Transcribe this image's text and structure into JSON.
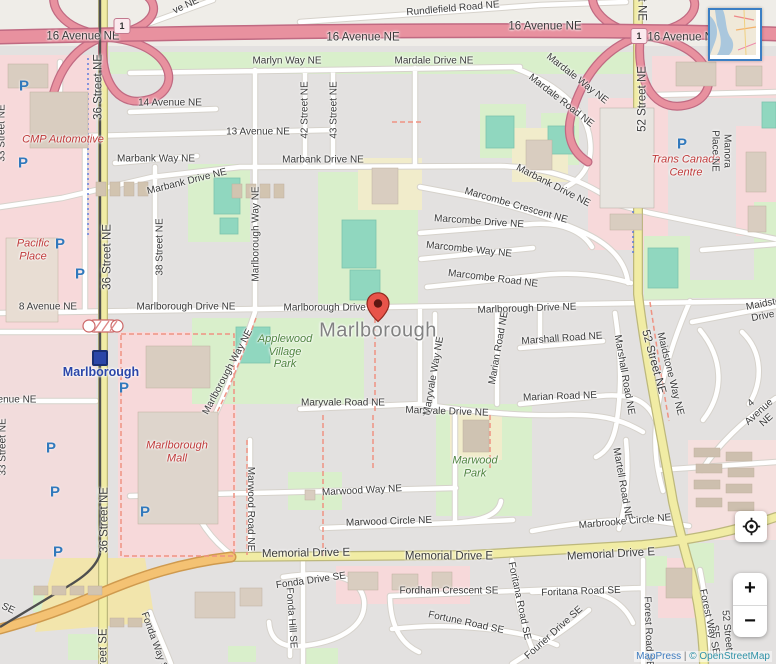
{
  "title": "Marlborough neighbourhood map",
  "marker": {
    "name": "Marlborough",
    "color": "#e8544a"
  },
  "city_label": "Marlborough",
  "station": {
    "name": "Marlborough",
    "icon": "ctrain-station-icon",
    "color": "#2b46a8"
  },
  "highway_shields": [
    {
      "label": "1",
      "x": 122,
      "y": 26
    },
    {
      "label": "1",
      "x": 639,
      "y": 36
    }
  ],
  "parking": {
    "glyph": "P",
    "color": "#3179bc",
    "positions": [
      [
        24,
        86
      ],
      [
        23,
        163
      ],
      [
        60,
        244
      ],
      [
        80,
        274
      ],
      [
        124,
        388
      ],
      [
        51,
        448
      ],
      [
        55,
        492
      ],
      [
        58,
        552
      ],
      [
        145,
        512
      ],
      [
        682,
        144
      ]
    ]
  },
  "controls": {
    "zoom_in": "+",
    "zoom_out": "−",
    "locate_icon": "crosshair-icon",
    "minimap": "overview-map"
  },
  "attribution": {
    "mappress": "MapPress",
    "sep": "|",
    "osm": "© OpenStreetMap"
  },
  "map_labels": [
    {
      "text": "Rundlefield Road NE",
      "x": 453,
      "y": 9,
      "rot": -5
    },
    {
      "text": "ve NE",
      "x": 186,
      "y": 6,
      "rot": -25
    },
    {
      "text": "16 Avenue NE",
      "x": 83,
      "y": 37,
      "cls": "major"
    },
    {
      "text": "16 Avenue NE",
      "x": 363,
      "y": 38,
      "cls": "major"
    },
    {
      "text": "16 Avenue NE",
      "x": 545,
      "y": 27,
      "cls": "major"
    },
    {
      "text": "16 Avenue NE",
      "x": 684,
      "y": 38,
      "cls": "major"
    },
    {
      "text": "Marlyn Way NE",
      "x": 287,
      "y": 61
    },
    {
      "text": "Mardale Drive NE",
      "x": 434,
      "y": 61
    },
    {
      "text": "Mardale Way NE",
      "x": 577,
      "y": 79,
      "rot": 38
    },
    {
      "text": "Mardale Road NE",
      "x": 561,
      "y": 101,
      "rot": 38
    },
    {
      "text": "14 Avenue NE",
      "x": 170,
      "y": 103
    },
    {
      "text": "13 Avenue NE",
      "x": 258,
      "y": 132
    },
    {
      "text": "42 Street NE",
      "x": 305,
      "y": 110,
      "rot": -90
    },
    {
      "text": "43 Street NE",
      "x": 334,
      "y": 110,
      "rot": -90
    },
    {
      "text": "36 Street NE",
      "x": 99,
      "y": 87,
      "rot": -90,
      "cls": "major"
    },
    {
      "text": "36 Street NE",
      "x": 108,
      "y": 257,
      "rot": -90,
      "cls": "major"
    },
    {
      "text": "36 Street NE",
      "x": 105,
      "y": 520,
      "rot": -90,
      "cls": "major"
    },
    {
      "text": "36 Street SE",
      "x": 104,
      "y": 661,
      "rot": -90,
      "cls": "major"
    },
    {
      "text": "52 Street NE",
      "x": 643,
      "y": 99,
      "rot": -90,
      "cls": "major"
    },
    {
      "text": "52 Street NE",
      "x": 653,
      "y": 362,
      "rot": 75,
      "cls": "major"
    },
    {
      "text": "52 Street NE",
      "x": 641,
      "y": -12,
      "rot": 90,
      "cls": "major"
    },
    {
      "text": "52 Street SE",
      "x": 721,
      "y": 631,
      "rot": 84
    },
    {
      "text": "33 Street NE",
      "x": 2,
      "y": 133,
      "rot": -90
    },
    {
      "text": "33 Street NE",
      "x": 3,
      "y": 447,
      "rot": -90
    },
    {
      "text": "38 Street NE",
      "x": 160,
      "y": 247,
      "rot": -90
    },
    {
      "text": "CMP Automotive",
      "x": 63,
      "y": 140,
      "cls": "poi-red"
    },
    {
      "text": "Marbank Way NE",
      "x": 156,
      "y": 159
    },
    {
      "text": "Marbank Drive NE",
      "x": 187,
      "y": 182,
      "rot": -14
    },
    {
      "text": "Marbank Drive NE",
      "x": 323,
      "y": 160
    },
    {
      "text": "Marbank Drive NE",
      "x": 553,
      "y": 186,
      "rot": 27
    },
    {
      "text": "Marcombe Crescent NE",
      "x": 516,
      "y": 206,
      "rot": 16
    },
    {
      "text": "Marcombe Drive NE",
      "x": 479,
      "y": 222,
      "rot": 4
    },
    {
      "text": "Marcombe Way NE",
      "x": 469,
      "y": 250,
      "rot": 6
    },
    {
      "text": "Marcombe Road NE",
      "x": 493,
      "y": 279,
      "rot": 7
    },
    {
      "text": "Marlborough Way NE",
      "x": 256,
      "y": 234,
      "rot": -90
    },
    {
      "text": "Marlborough Way NE",
      "x": 228,
      "y": 372,
      "rot": -62
    },
    {
      "text": "8 Avenue NE",
      "x": 48,
      "y": 307
    },
    {
      "text": "Marlborough Drive NE",
      "x": 186,
      "y": 307
    },
    {
      "text": "Marlborough Drive NE",
      "x": 333,
      "y": 308
    },
    {
      "text": "Marlborough Drive NE",
      "x": 527,
      "y": 309,
      "rot": -2
    },
    {
      "text": "Pacific\nPlace",
      "x": 33,
      "y": 250,
      "cls": "poi-red"
    },
    {
      "text": "Marlborough",
      "x": 101,
      "y": 372,
      "cls": "station"
    },
    {
      "text": "",
      "x": 100,
      "y": 358,
      "cls": "station-icon"
    },
    {
      "text": "Marlborough",
      "x": 378,
      "y": 331,
      "cls": "city"
    },
    {
      "text": "Applewood\nVillage\nPark",
      "x": 285,
      "y": 352,
      "cls": "poi-green"
    },
    {
      "text": "Marlborough\nMall",
      "x": 177,
      "y": 452,
      "cls": "poi-red"
    },
    {
      "text": "Trans Canada\nCentre",
      "x": 686,
      "y": 166,
      "cls": "poi-red"
    },
    {
      "text": "Manora Place NE",
      "x": 721,
      "y": 151,
      "rot": 90
    },
    {
      "text": "Marshall Road NE",
      "x": 562,
      "y": 339,
      "rot": -4
    },
    {
      "text": "Marshall Road NE",
      "x": 624,
      "y": 375,
      "rot": 80
    },
    {
      "text": "Marian Road NE",
      "x": 499,
      "y": 348,
      "rot": -80
    },
    {
      "text": "Marian Road NE",
      "x": 560,
      "y": 397,
      "rot": -2
    },
    {
      "text": "Maryvale Road NE",
      "x": 343,
      "y": 403
    },
    {
      "text": "Maryvale Drive NE",
      "x": 447,
      "y": 412,
      "rot": 2
    },
    {
      "text": "Maryvale Way NE",
      "x": 434,
      "y": 376,
      "rot": -80
    },
    {
      "text": "Maidstone Way NE",
      "x": 670,
      "y": 374,
      "rot": 76
    },
    {
      "text": "Maidstone Drive NE",
      "x": 770,
      "y": 309,
      "rot": -11
    },
    {
      "text": "4 Avenue NE",
      "x": 759,
      "y": 412,
      "rot": -42
    },
    {
      "text": "enue NE",
      "x": 17,
      "y": 400
    },
    {
      "text": "Marwood Way NE",
      "x": 362,
      "y": 491,
      "rot": -3
    },
    {
      "text": "Marwood Circle NE",
      "x": 389,
      "y": 522,
      "rot": -2
    },
    {
      "text": "Marwood Road NE",
      "x": 250,
      "y": 509,
      "rot": 90
    },
    {
      "text": "Marwood\nPark",
      "x": 475,
      "y": 467,
      "cls": "poi-green"
    },
    {
      "text": "Marbrooke Circle NE",
      "x": 625,
      "y": 522,
      "rot": -5
    },
    {
      "text": "Martell Road NE",
      "x": 622,
      "y": 484,
      "rot": 80
    },
    {
      "text": "Memorial Drive E",
      "x": 306,
      "y": 554,
      "rot": -1,
      "cls": "major"
    },
    {
      "text": "Memorial Drive E",
      "x": 449,
      "y": 557,
      "cls": "major"
    },
    {
      "text": "Memorial Drive E",
      "x": 611,
      "y": 555,
      "rot": -3,
      "cls": "major"
    },
    {
      "text": "SE",
      "x": 8,
      "y": 609,
      "rot": 25
    },
    {
      "text": "Fonda Drive SE",
      "x": 311,
      "y": 581,
      "rot": -8
    },
    {
      "text": "Fonda Hill SE",
      "x": 291,
      "y": 618,
      "rot": 86
    },
    {
      "text": "Fonda Way SE",
      "x": 155,
      "y": 644,
      "rot": 70
    },
    {
      "text": "Fordham Crescent SE",
      "x": 449,
      "y": 591
    },
    {
      "text": "Fortune Road SE",
      "x": 466,
      "y": 623,
      "rot": 12
    },
    {
      "text": "Foritana Road SE",
      "x": 519,
      "y": 601,
      "rot": 78
    },
    {
      "text": "Foritana Road SE",
      "x": 581,
      "y": 592,
      "rot": -2
    },
    {
      "text": "Fourier Drive SE",
      "x": 554,
      "y": 633,
      "rot": -42
    },
    {
      "text": "Forest Road SE",
      "x": 648,
      "y": 632,
      "rot": 88
    },
    {
      "text": "Forest Way SE",
      "x": 709,
      "y": 622,
      "rot": 78
    }
  ]
}
